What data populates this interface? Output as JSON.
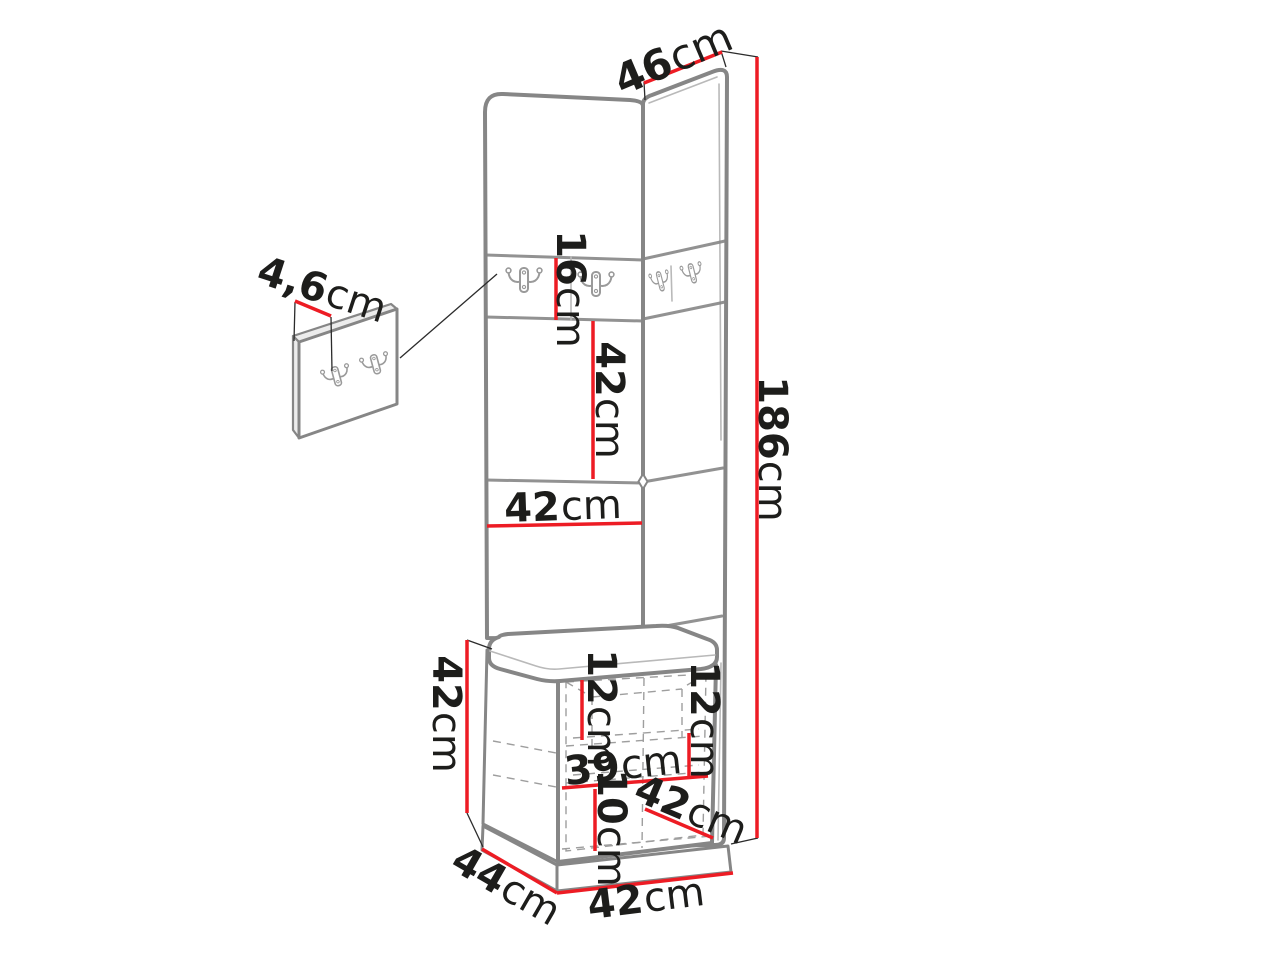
{
  "diagram": {
    "dims": {
      "top_width": {
        "value": "46",
        "unit": "cm"
      },
      "total_height": {
        "value": "186",
        "unit": "cm"
      },
      "hook_panel_depth": {
        "value": "4,6",
        "unit": "cm"
      },
      "hook_row_height": {
        "value": "16",
        "unit": "cm"
      },
      "mid_panel_height": {
        "value": "42",
        "unit": "cm"
      },
      "panel_width": {
        "value": "42",
        "unit": "cm"
      },
      "bench_height": {
        "value": "42",
        "unit": "cm"
      },
      "inner_top": {
        "value": "12",
        "unit": "cm"
      },
      "inner_right": {
        "value": "12",
        "unit": "cm"
      },
      "inner_width": {
        "value": "39",
        "unit": "cm"
      },
      "bottom_section": {
        "value": "10",
        "unit": "cm"
      },
      "seat_depth_diag": {
        "value": "42",
        "unit": "cm"
      },
      "base_depth": {
        "value": "44",
        "unit": "cm"
      },
      "base_width": {
        "value": "42",
        "unit": "cm"
      }
    },
    "colors": {
      "dimension_red": "#ed1c24",
      "outline_gray": "#868686",
      "text_ink": "#1d1d1b",
      "background": "#ffffff"
    }
  }
}
